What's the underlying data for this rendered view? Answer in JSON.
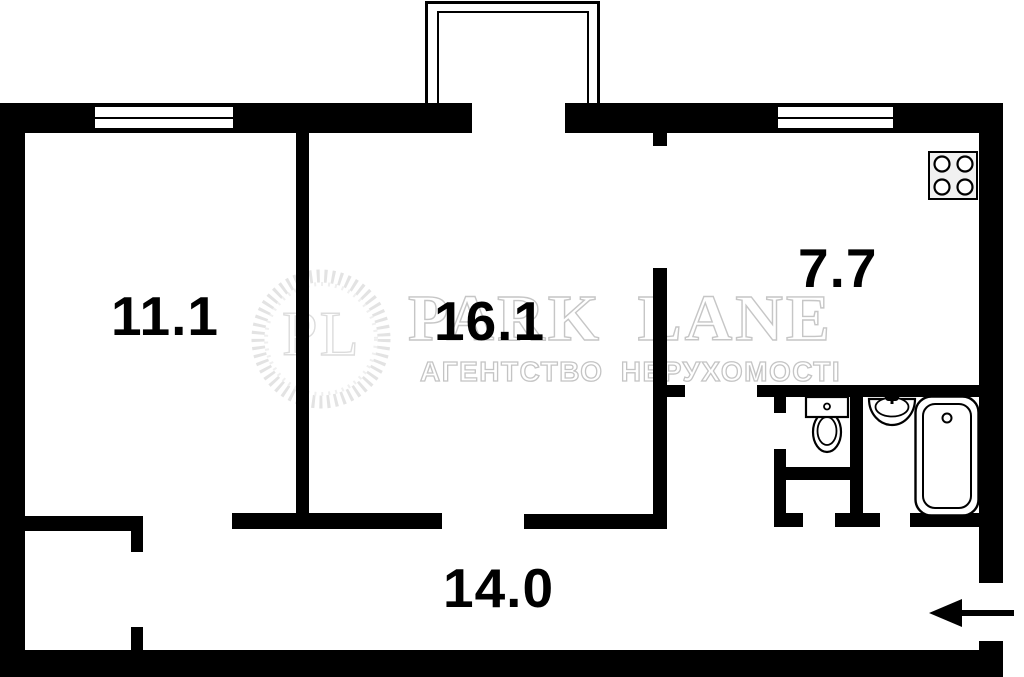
{
  "watermark": {
    "monogram": "PL",
    "brand": "PARK LANE",
    "tagline": "АГЕНТСТВО НЕРУХОМОСТІ"
  },
  "rooms": [
    {
      "id": "room-1",
      "label": "11.1"
    },
    {
      "id": "room-2",
      "label": "16.1"
    },
    {
      "id": "kitchen",
      "label": "7.7"
    },
    {
      "id": "hallway",
      "label": "14.0"
    }
  ],
  "fixtures": {
    "stove": "stove-icon",
    "toilet": "toilet-icon",
    "sink": "sink-icon",
    "bathtub": "bathtub-icon",
    "entrance": "entrance-arrow-icon",
    "windows": 2,
    "balcony": "balcony"
  },
  "colors": {
    "wall": "#000000",
    "background": "#ffffff",
    "watermark_gray": "#c8c8c8",
    "stove_fill": "#f1f1f1"
  }
}
